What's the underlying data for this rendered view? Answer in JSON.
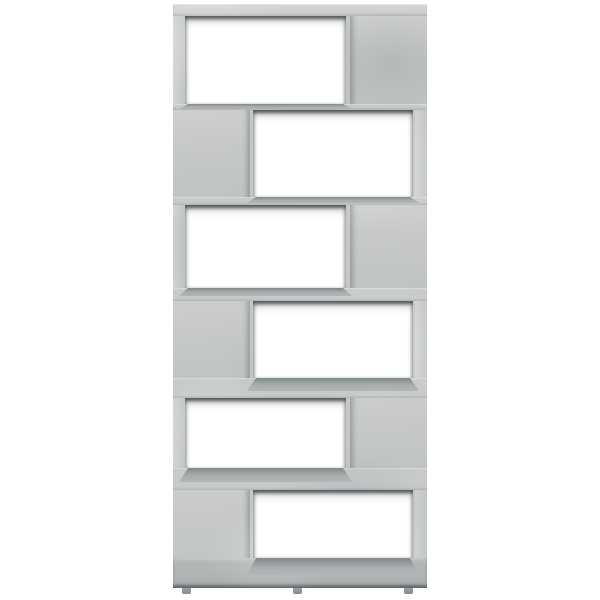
{
  "scene": {
    "description": "Product photo of a zigzag book cabinet room divider in concrete gray with six open compartments, standing on small feet against a plain white background",
    "object": "book-cabinet-room-divider",
    "finish": "concrete-gray",
    "background_color": "#ffffff",
    "compartment_count": 6,
    "compartments": [
      {
        "position": 1,
        "open_side": "left"
      },
      {
        "position": 2,
        "open_side": "right"
      },
      {
        "position": 3,
        "open_side": "left"
      },
      {
        "position": 4,
        "open_side": "right"
      },
      {
        "position": 5,
        "open_side": "left"
      },
      {
        "position": 6,
        "open_side": "right"
      }
    ],
    "feet_count": 3,
    "colors": {
      "background": "#ffffff",
      "body": "#c6c8c8",
      "body_light": "#cfd1d1",
      "strip": "#d1d3d3",
      "band": "#c9cbcb",
      "bottom_band": "#b5b8b8",
      "shelf_surface": "#a9adad",
      "shadow_dark": "#6f7578",
      "foot": "#9b9ea0",
      "opening": "#ffffff"
    }
  }
}
